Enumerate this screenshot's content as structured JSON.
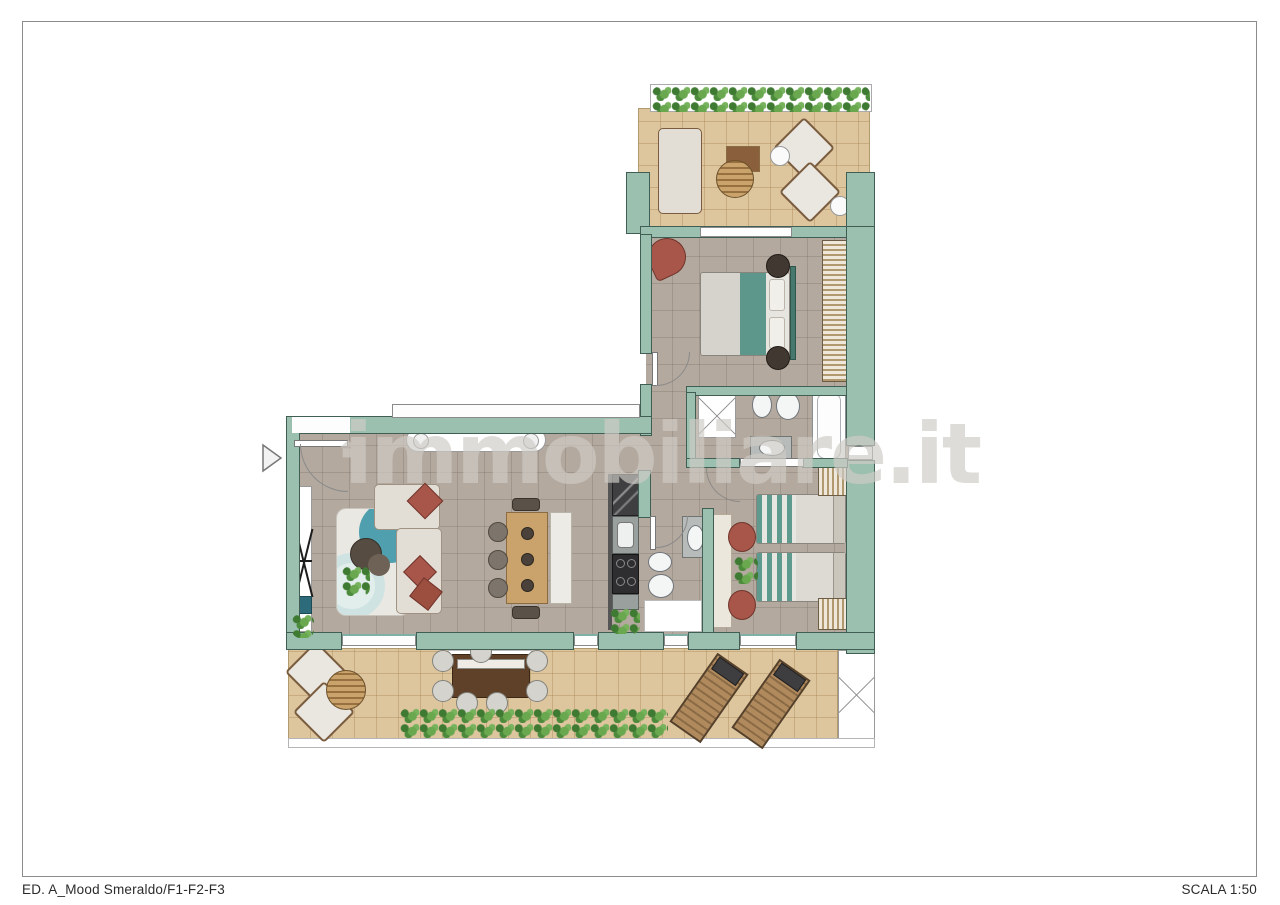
{
  "page": {
    "footer_left": "ED. A_Mood Smeraldo/F1-F2-F3",
    "footer_right": "SCALA 1:50",
    "frame_border_color": "#8c8c8c",
    "background_color": "#ffffff"
  },
  "watermark": {
    "text": "immobiliare.it",
    "icon": "house-icon",
    "color": "#cfccc6"
  },
  "plan": {
    "type": "apartment-floor-plan",
    "colors": {
      "wall": "#9cc0af",
      "wall_outline": "#415e55",
      "floor_interior": "#b3a99e",
      "floor_terrace": "#ddc59e",
      "fixture_white": "#ffffff",
      "wood": "#c9a36b",
      "dark_wood": "#5e4128",
      "terracotta": "#a8564a",
      "teal_bedding": "#5d968b",
      "foliage_green": "#4c8a3c",
      "kitchen_dark": "#3a3a3c"
    }
  }
}
